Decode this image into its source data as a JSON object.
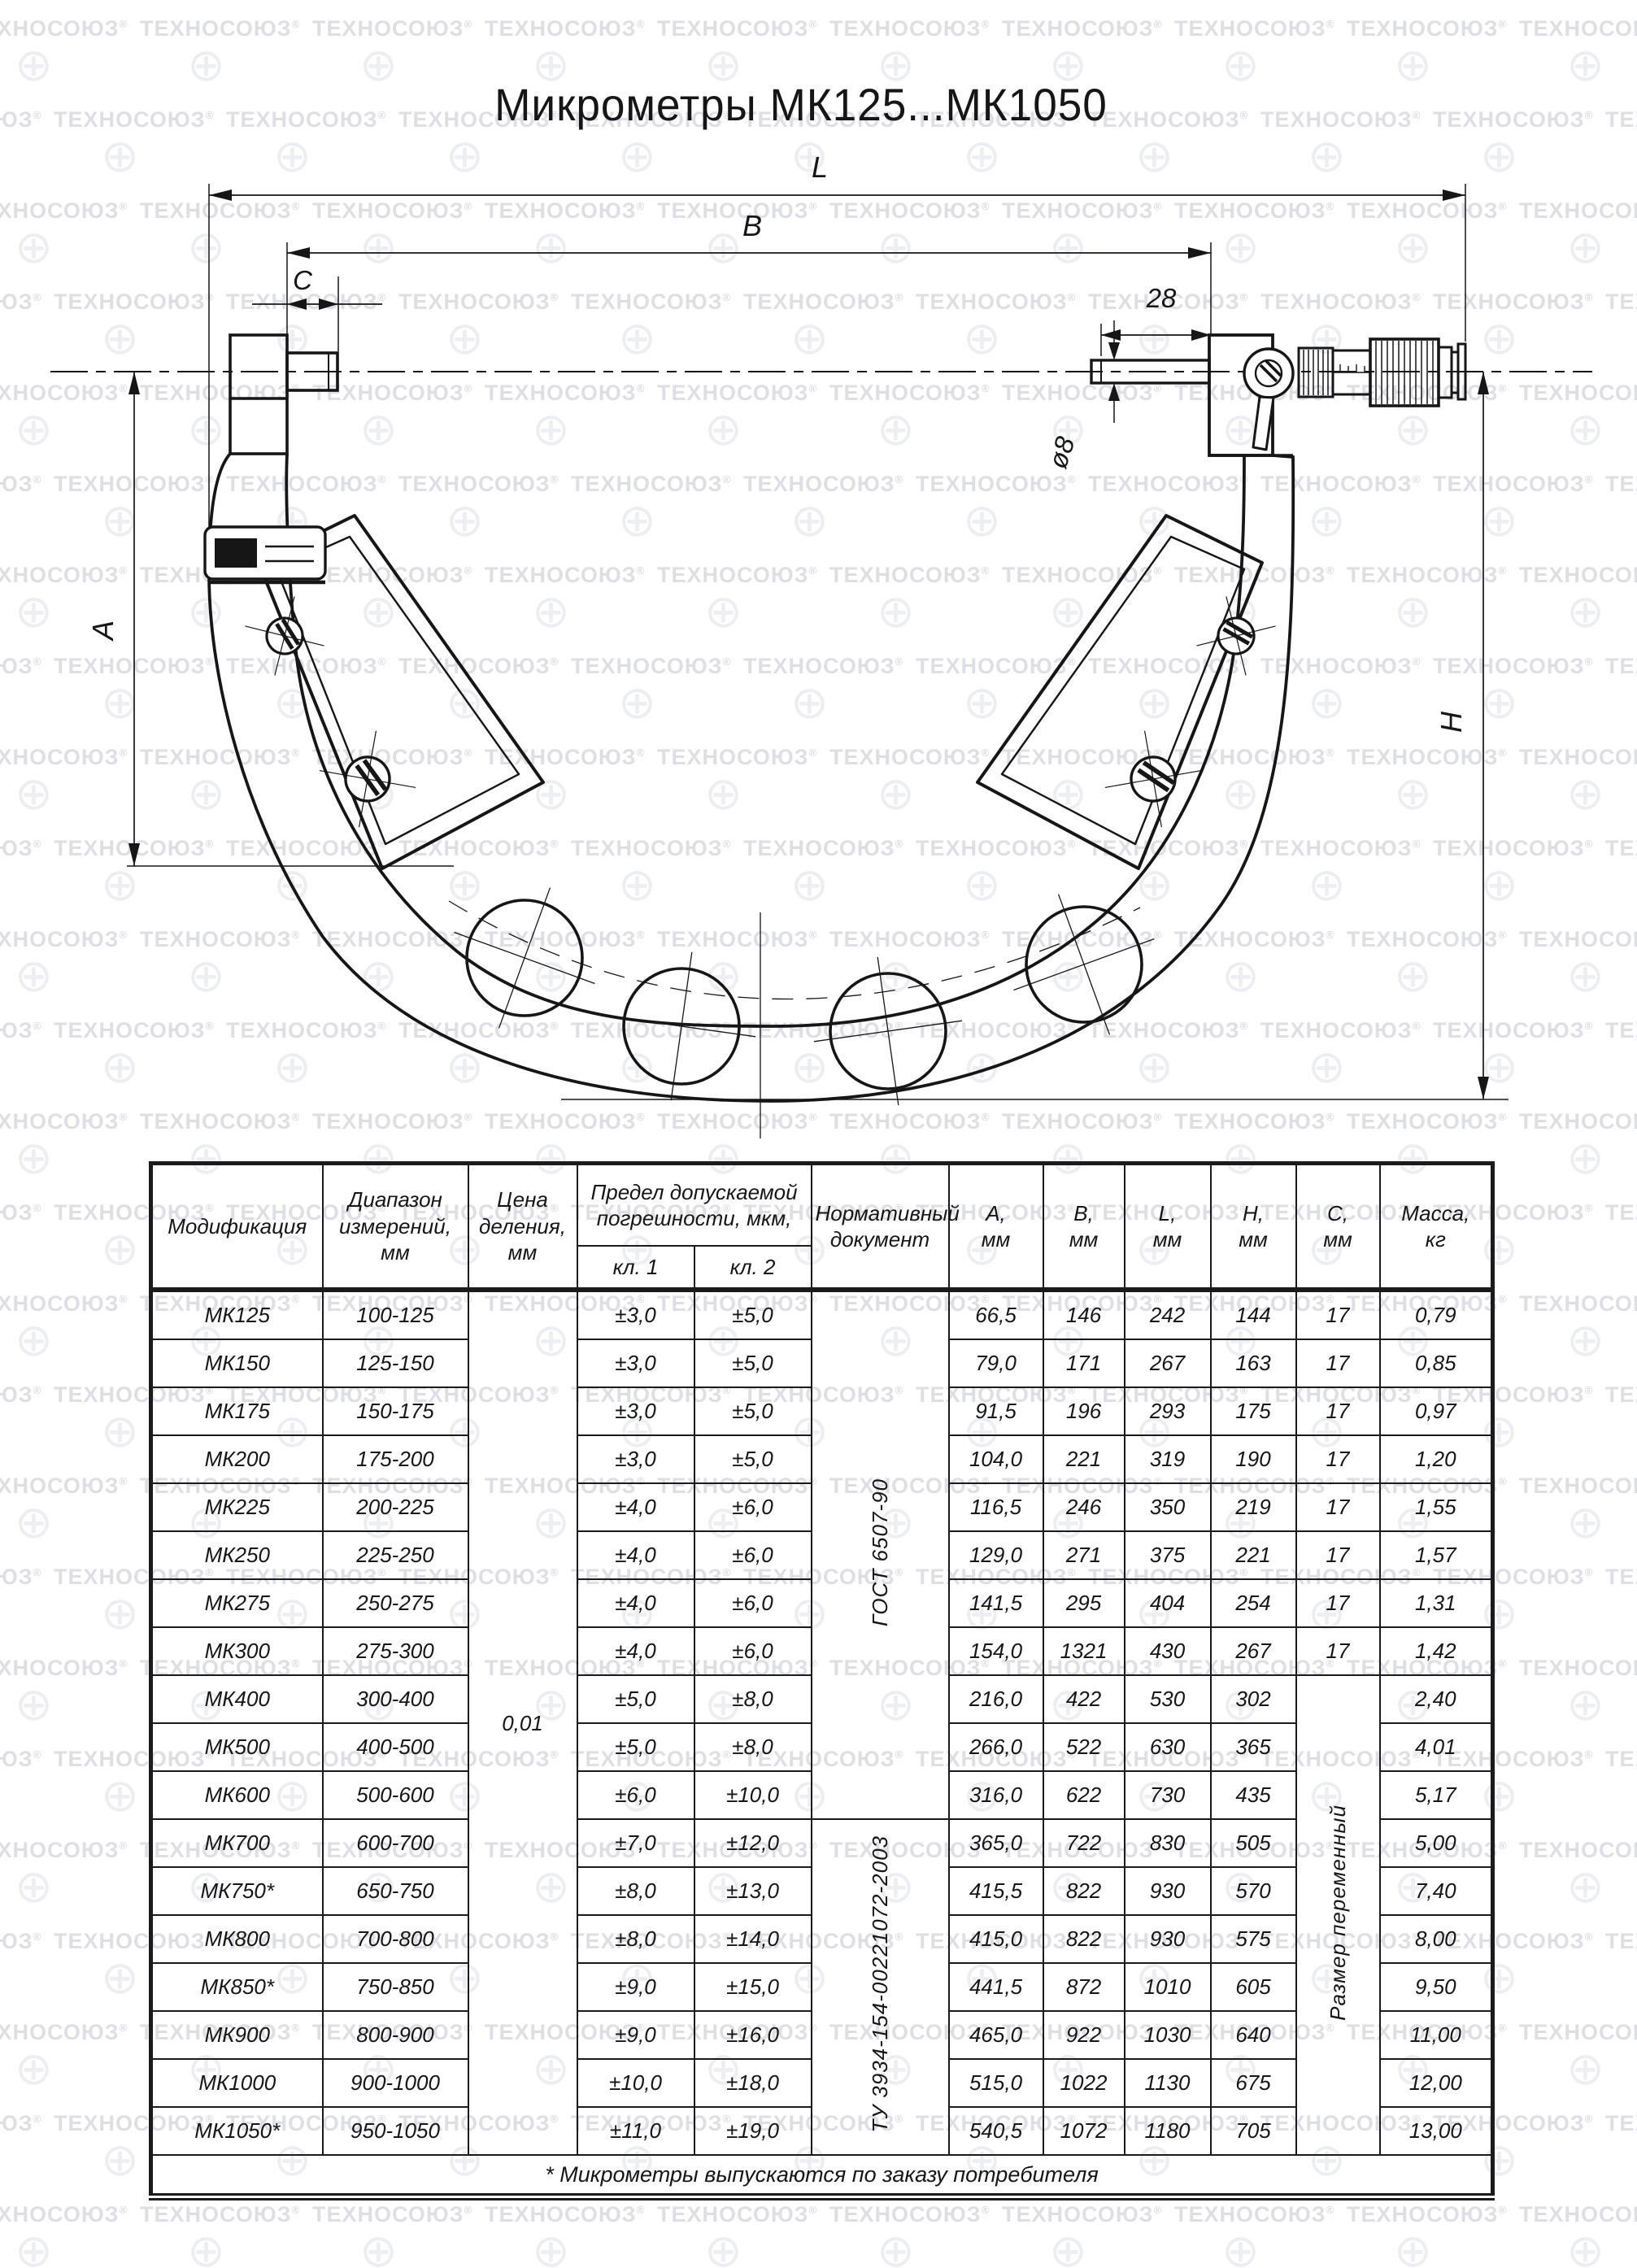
{
  "title": "Микрометры МК125...МК1050",
  "watermark": {
    "text": "ТЕХНОСОЮЗ",
    "reg": "®",
    "globe": "⊕"
  },
  "drawing": {
    "labels": {
      "L": "L",
      "B": "B",
      "C": "C",
      "dim28": "28",
      "dia8": "ø8",
      "A": "A",
      "H": "H"
    }
  },
  "table": {
    "headers": {
      "mod": "Модификация",
      "range": "Диапазон\nизмерений,\nмм",
      "division": "Цена\nделения,\nмм",
      "limit": "Предел допускаемой\nпогрешности, мкм,",
      "kl1": "кл. 1",
      "kl2": "кл. 2",
      "doc": "Нормативный\nдокумент",
      "a": "А,\nмм",
      "b": "В,\nмм",
      "l": "L,\nмм",
      "h": "Н,\nмм",
      "c": "С,\nмм",
      "mass": "Масса,\nкг"
    },
    "merged": {
      "division_value": "0,01",
      "doc1": "ГОСТ 6507-90",
      "doc1_rows": 11,
      "doc2": "ТУ 3934-154-00221072-2003",
      "doc2_rows": 7,
      "c_value_rows": 8,
      "c_merged": "Размер переменный",
      "c_merged_rows": 10
    },
    "rows": [
      {
        "mod": "МК125",
        "range": "100-125",
        "kl1": "±3,0",
        "kl2": "±5,0",
        "a": "66,5",
        "b": "146",
        "l": "242",
        "h": "144",
        "c": "17",
        "mass": "0,79"
      },
      {
        "mod": "МК150",
        "range": "125-150",
        "kl1": "±3,0",
        "kl2": "±5,0",
        "a": "79,0",
        "b": "171",
        "l": "267",
        "h": "163",
        "c": "17",
        "mass": "0,85"
      },
      {
        "mod": "МК175",
        "range": "150-175",
        "kl1": "±3,0",
        "kl2": "±5,0",
        "a": "91,5",
        "b": "196",
        "l": "293",
        "h": "175",
        "c": "17",
        "mass": "0,97"
      },
      {
        "mod": "МК200",
        "range": "175-200",
        "kl1": "±3,0",
        "kl2": "±5,0",
        "a": "104,0",
        "b": "221",
        "l": "319",
        "h": "190",
        "c": "17",
        "mass": "1,20"
      },
      {
        "mod": "МК225",
        "range": "200-225",
        "kl1": "±4,0",
        "kl2": "±6,0",
        "a": "116,5",
        "b": "246",
        "l": "350",
        "h": "219",
        "c": "17",
        "mass": "1,55"
      },
      {
        "mod": "МК250",
        "range": "225-250",
        "kl1": "±4,0",
        "kl2": "±6,0",
        "a": "129,0",
        "b": "271",
        "l": "375",
        "h": "221",
        "c": "17",
        "mass": "1,57"
      },
      {
        "mod": "МК275",
        "range": "250-275",
        "kl1": "±4,0",
        "kl2": "±6,0",
        "a": "141,5",
        "b": "295",
        "l": "404",
        "h": "254",
        "c": "17",
        "mass": "1,31"
      },
      {
        "mod": "МК300",
        "range": "275-300",
        "kl1": "±4,0",
        "kl2": "±6,0",
        "a": "154,0",
        "b": "1321",
        "l": "430",
        "h": "267",
        "c": "17",
        "mass": "1,42"
      },
      {
        "mod": "МК400",
        "range": "300-400",
        "kl1": "±5,0",
        "kl2": "±8,0",
        "a": "216,0",
        "b": "422",
        "l": "530",
        "h": "302",
        "c": "",
        "mass": "2,40"
      },
      {
        "mod": "МК500",
        "range": "400-500",
        "kl1": "±5,0",
        "kl2": "±8,0",
        "a": "266,0",
        "b": "522",
        "l": "630",
        "h": "365",
        "c": "",
        "mass": "4,01"
      },
      {
        "mod": "МК600",
        "range": "500-600",
        "kl1": "±6,0",
        "kl2": "±10,0",
        "a": "316,0",
        "b": "622",
        "l": "730",
        "h": "435",
        "c": "",
        "mass": "5,17"
      },
      {
        "mod": "МК700",
        "range": "600-700",
        "kl1": "±7,0",
        "kl2": "±12,0",
        "a": "365,0",
        "b": "722",
        "l": "830",
        "h": "505",
        "c": "",
        "mass": "5,00"
      },
      {
        "mod": "МК750*",
        "range": "650-750",
        "kl1": "±8,0",
        "kl2": "±13,0",
        "a": "415,5",
        "b": "822",
        "l": "930",
        "h": "570",
        "c": "",
        "mass": "7,40"
      },
      {
        "mod": "МК800",
        "range": "700-800",
        "kl1": "±8,0",
        "kl2": "±14,0",
        "a": "415,0",
        "b": "822",
        "l": "930",
        "h": "575",
        "c": "",
        "mass": "8,00"
      },
      {
        "mod": "МК850*",
        "range": "750-850",
        "kl1": "±9,0",
        "kl2": "±15,0",
        "a": "441,5",
        "b": "872",
        "l": "1010",
        "h": "605",
        "c": "",
        "mass": "9,50"
      },
      {
        "mod": "МК900",
        "range": "800-900",
        "kl1": "±9,0",
        "kl2": "±16,0",
        "a": "465,0",
        "b": "922",
        "l": "1030",
        "h": "640",
        "c": "",
        "mass": "11,00"
      },
      {
        "mod": "МК1000",
        "range": "900-1000",
        "kl1": "±10,0",
        "kl2": "±18,0",
        "a": "515,0",
        "b": "1022",
        "l": "1130",
        "h": "675",
        "c": "",
        "mass": "12,00"
      },
      {
        "mod": "МК1050*",
        "range": "950-1050",
        "kl1": "±11,0",
        "kl2": "±19,0",
        "a": "540,5",
        "b": "1072",
        "l": "1180",
        "h": "705",
        "c": "",
        "mass": "13,00"
      }
    ],
    "footnote": "* Микрометры выпускаются по заказу потребителя"
  }
}
